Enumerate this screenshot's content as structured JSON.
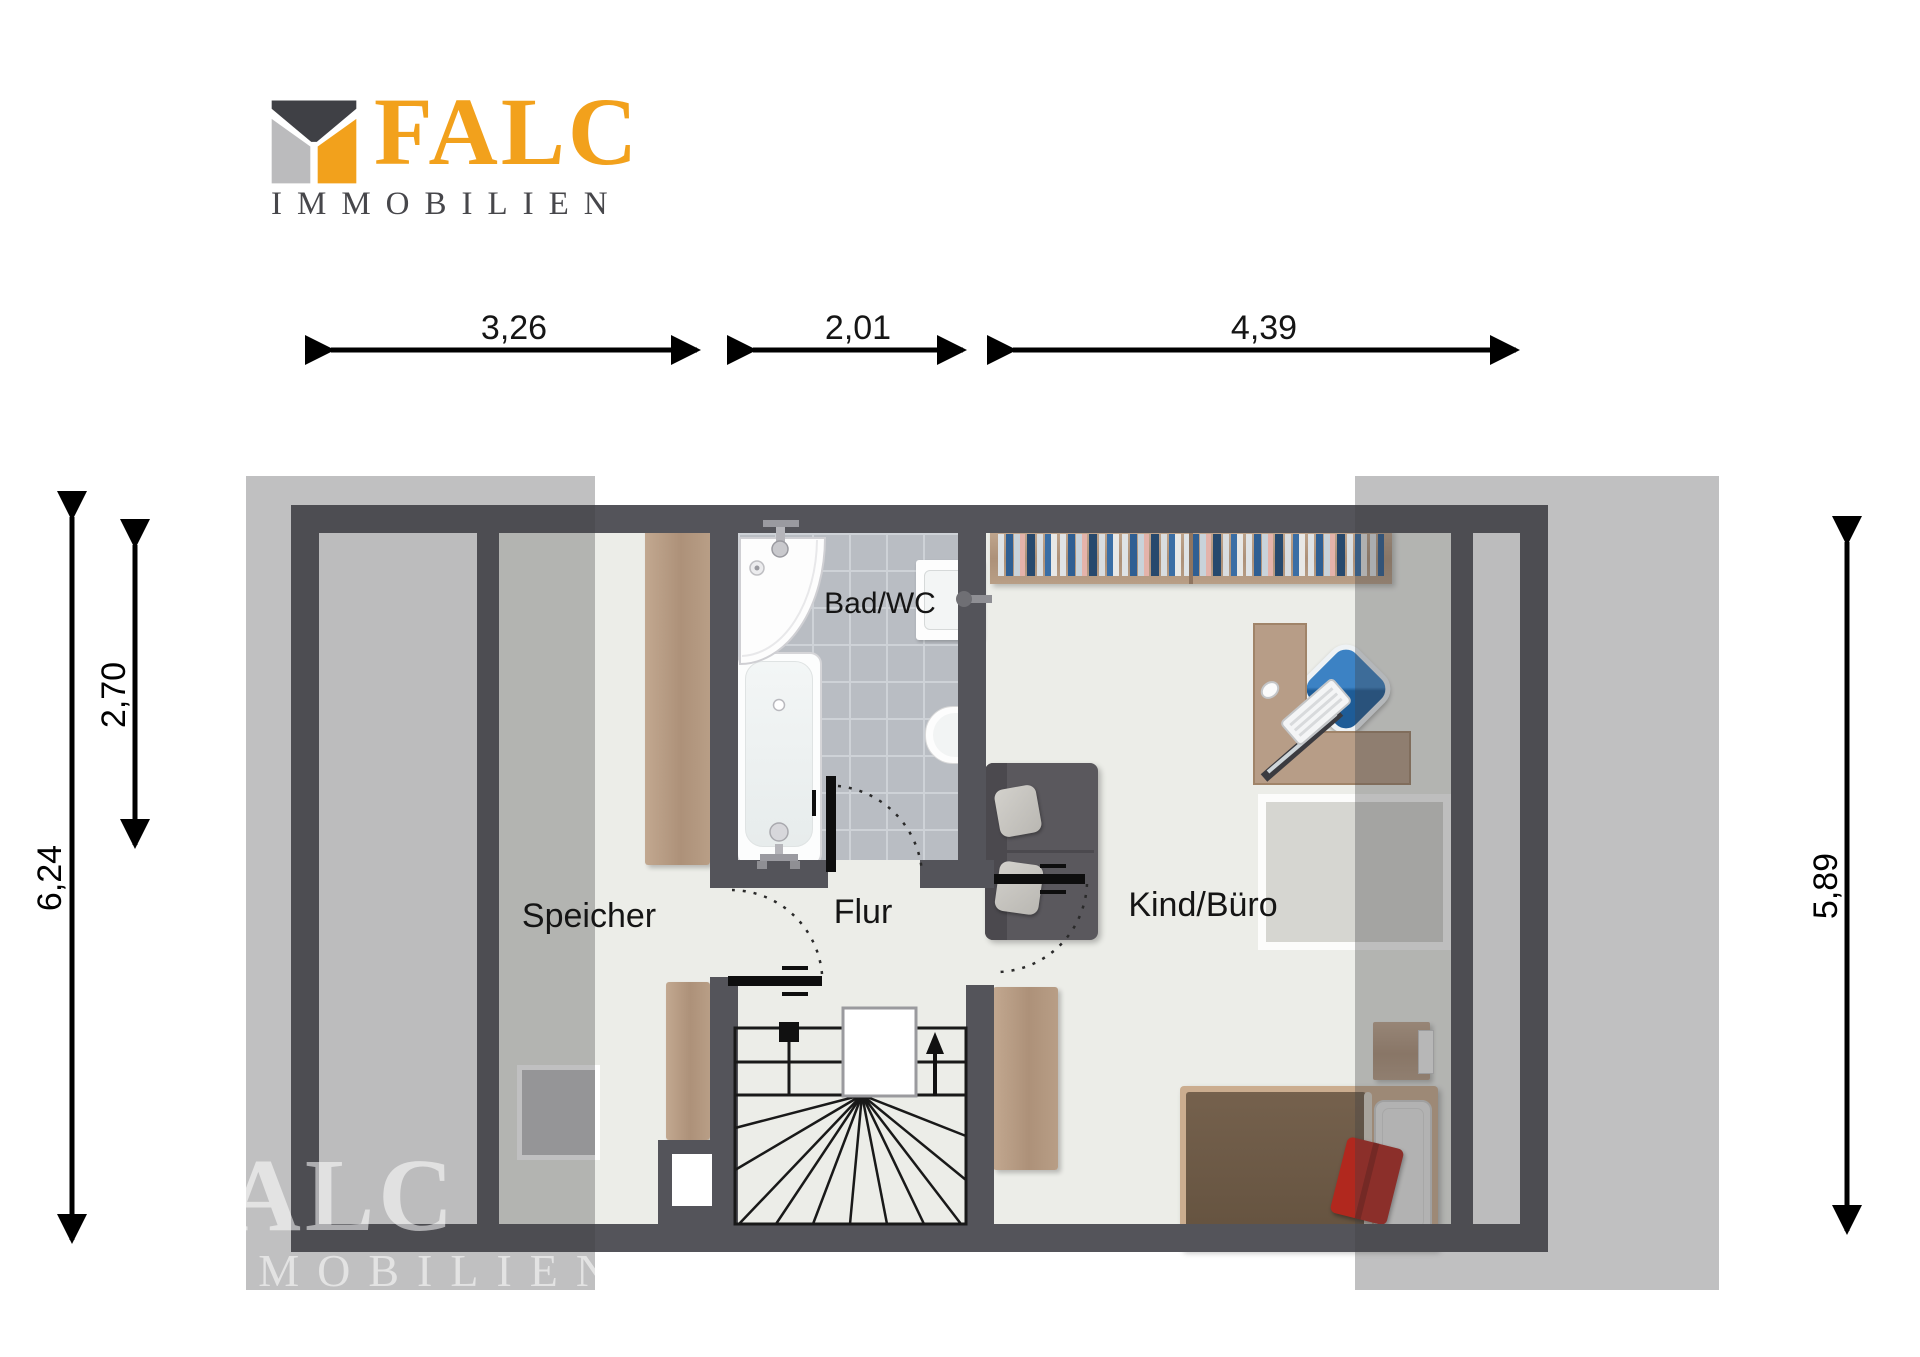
{
  "logo": {
    "brand": "FALC",
    "subtitle": "IMMOBILIEN",
    "accent_orange": "#F2A11C",
    "icon_dark": "#3F4045",
    "icon_gray": "#BBBBBD",
    "subtitle_color": "#47474B"
  },
  "watermark": {
    "line1": "FALC",
    "line2": "IMMOBILIEN"
  },
  "floorplan": {
    "rooms": [
      {
        "id": "speicher",
        "label": "Speicher"
      },
      {
        "id": "bad_wc",
        "label": "Bad/WC"
      },
      {
        "id": "flur",
        "label": "Flur"
      },
      {
        "id": "kind_buero",
        "label": "Kind/Büro"
      }
    ],
    "dimensions": {
      "top": [
        {
          "label": "3,26"
        },
        {
          "label": "2,01"
        },
        {
          "label": "4,39"
        }
      ],
      "left_outer": {
        "label": "6,24"
      },
      "left_inner": {
        "label": "2,70"
      },
      "right": {
        "label": "5,89"
      }
    },
    "colors": {
      "wall": "#54545A",
      "floor": "#ECEDE8",
      "tile": "#B9BDC3",
      "wood": "#B49A84",
      "slope_overlay": "rgba(64,64,68,0.33)",
      "chair_blue": "#2F74B5",
      "cushion_red": "#B1281E"
    }
  }
}
